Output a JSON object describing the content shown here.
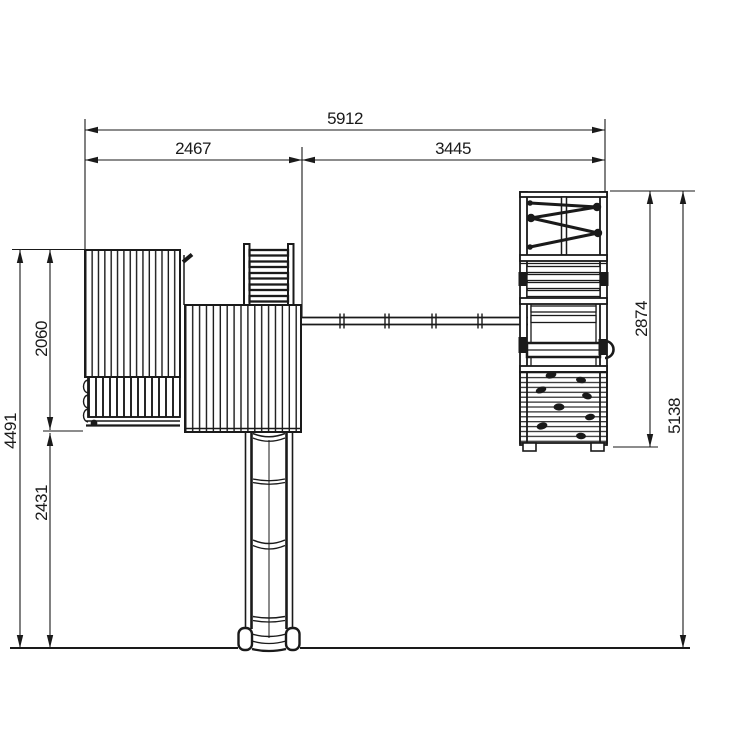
{
  "figure": {
    "background": "#ffffff",
    "line_color": "#1a1a1a",
    "type": "playground-set-top-view-dimension-drawing",
    "dimensions": {
      "overall_width": "5912",
      "playhouse_section_width": "2467",
      "swing_section_width": "3445",
      "playhouse_depth": "2060",
      "overall_depth_left": "4491",
      "slide_extension": "2431",
      "swing_frame_depth": "2874",
      "overall_depth_right": "5138"
    }
  }
}
